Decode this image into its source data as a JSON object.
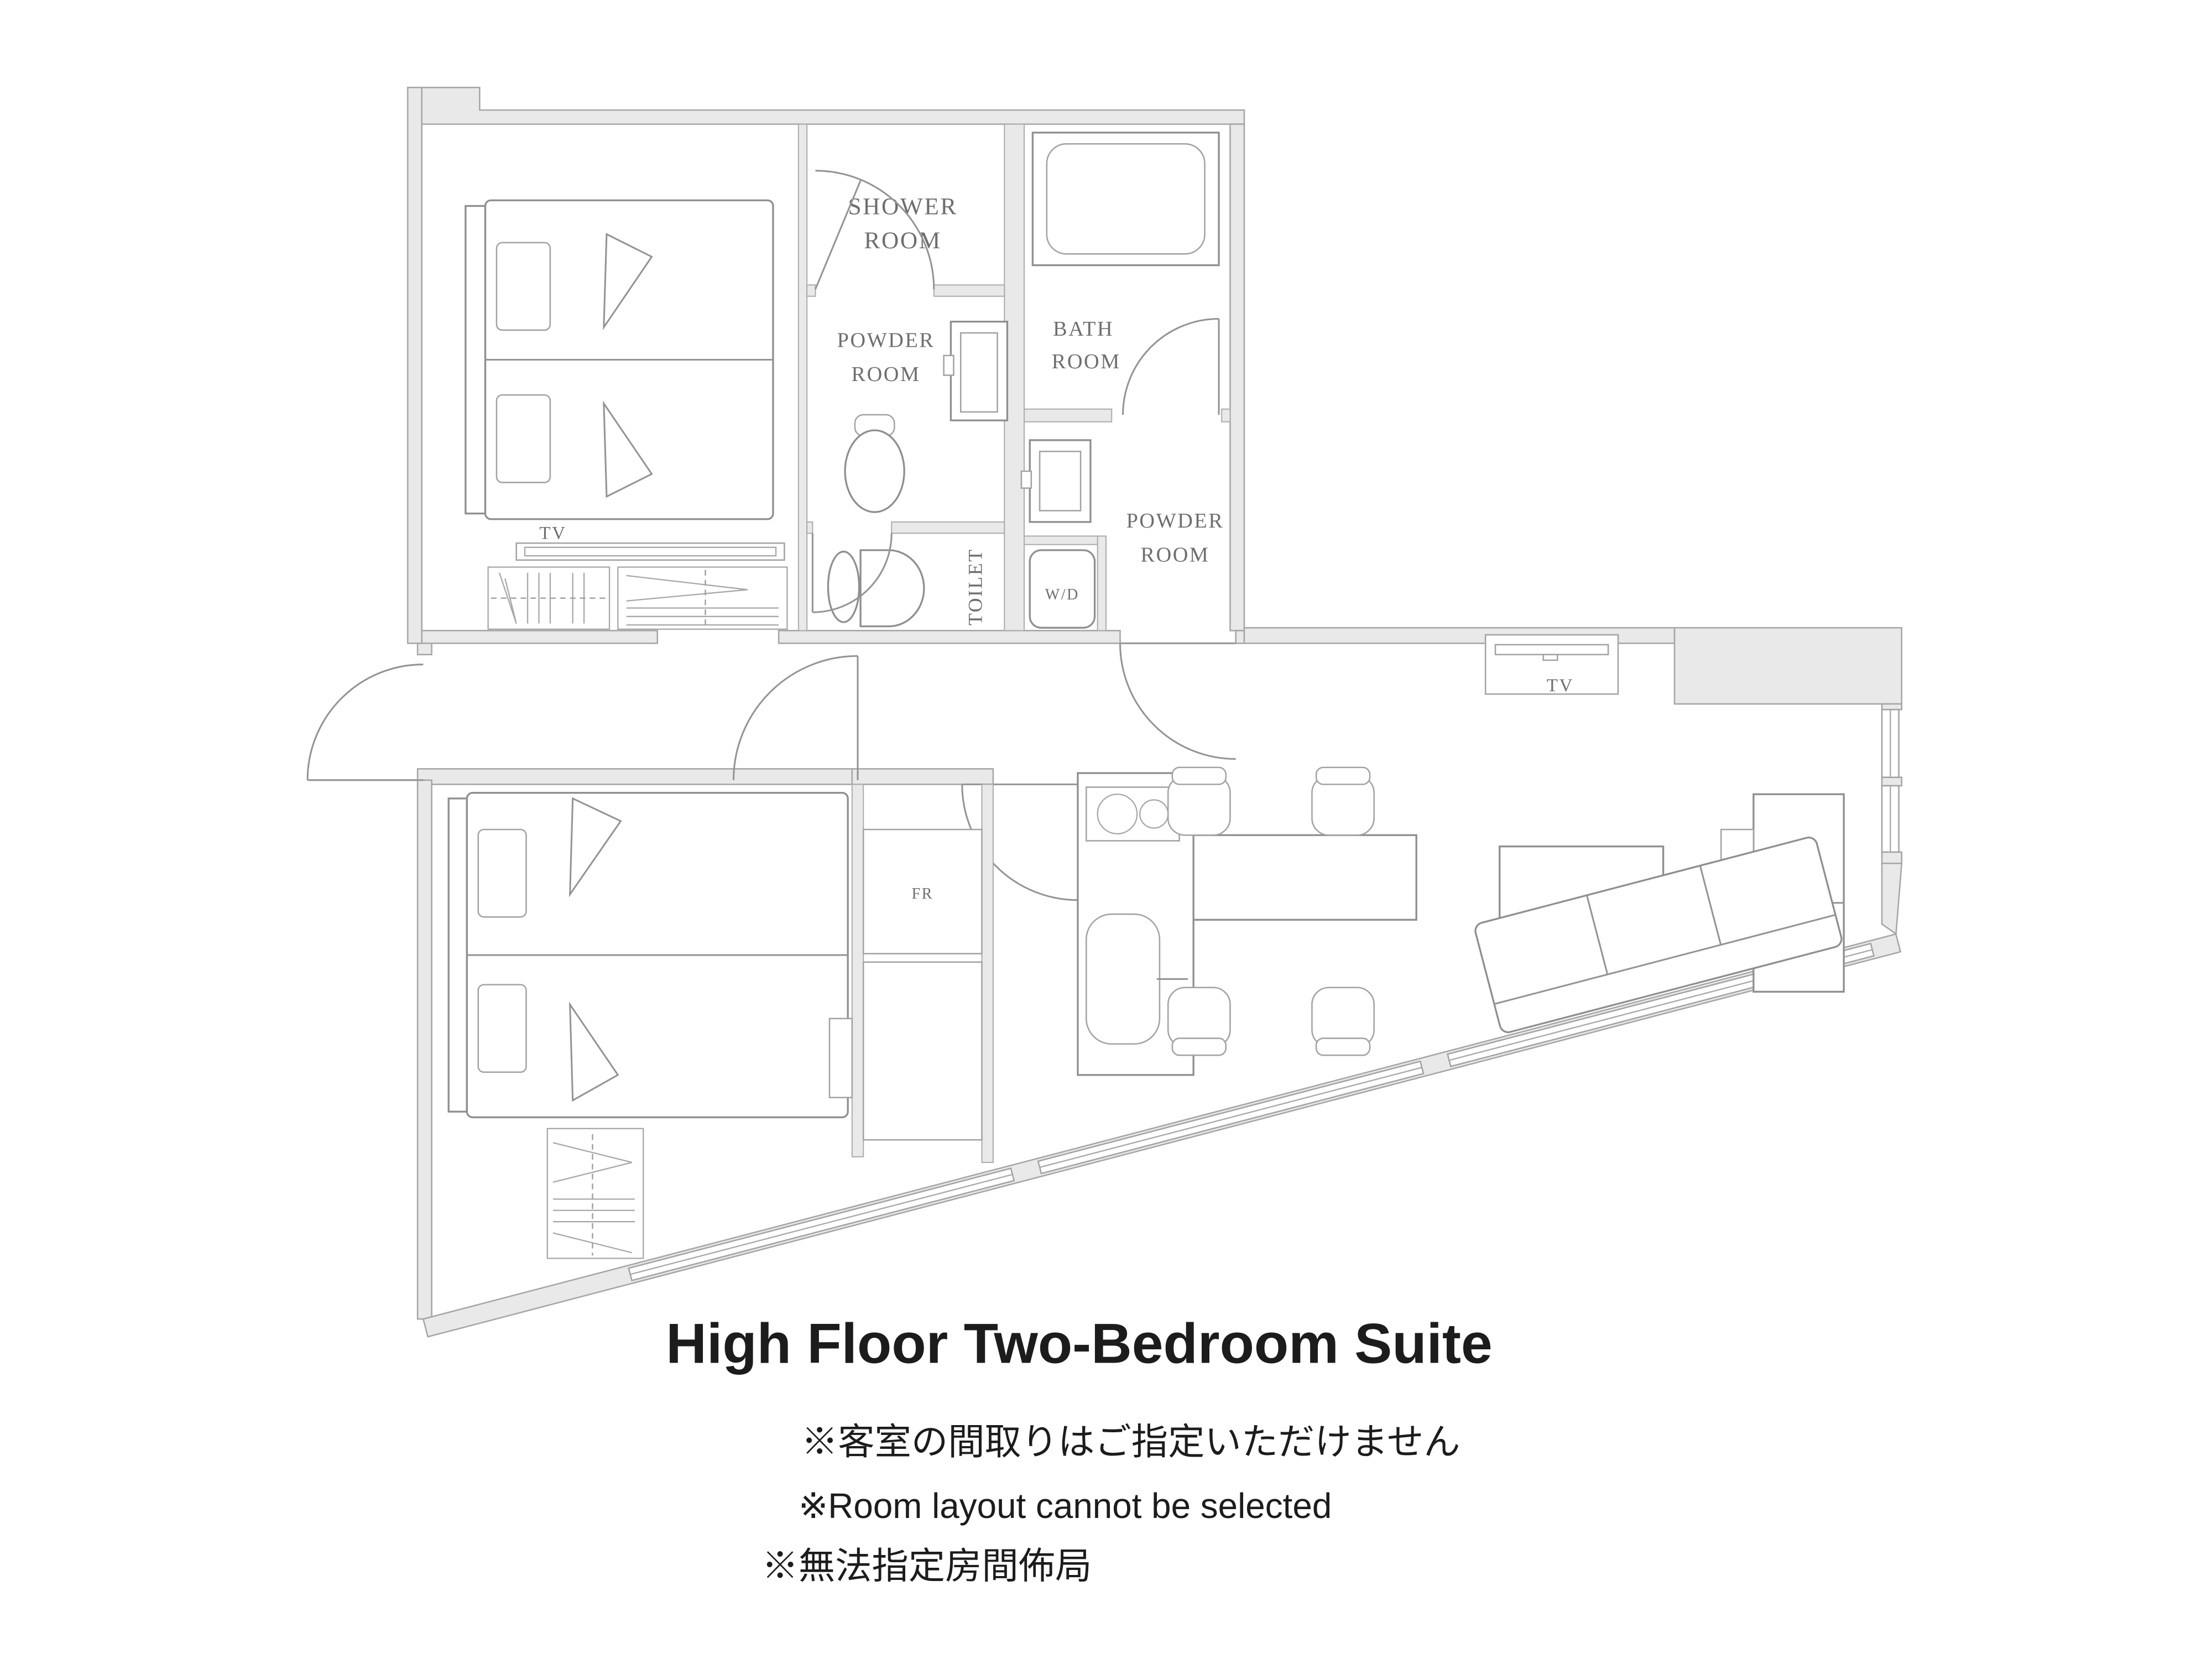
{
  "title": "High Floor Two-Bedroom Suite",
  "notes": [
    "※客室の間取りはご指定いただけません",
    "※Room layout cannot be selected",
    "※無法指定房間佈局"
  ],
  "floorplan": {
    "labels": {
      "shower_line1": "SHOWER",
      "shower_line2": "ROOM",
      "powder1_line1": "POWDER",
      "powder1_line2": "ROOM",
      "bath_line1": "BATH",
      "bath_line2": "ROOM",
      "toilet": "TOILET",
      "wd": "W/D",
      "powder2_line1": "POWDER",
      "powder2_line2": "ROOM",
      "tv_bedroom": "TV",
      "tv_living": "TV",
      "fridge": "FR"
    }
  },
  "colors": {
    "wall_fill": "#e9e9e9",
    "wall_edge": "#a6a6a6",
    "fixture_line": "#8f8f8f",
    "room_label": "#6e6e6e",
    "text": "#1c1c1c",
    "background": "#ffffff"
  }
}
